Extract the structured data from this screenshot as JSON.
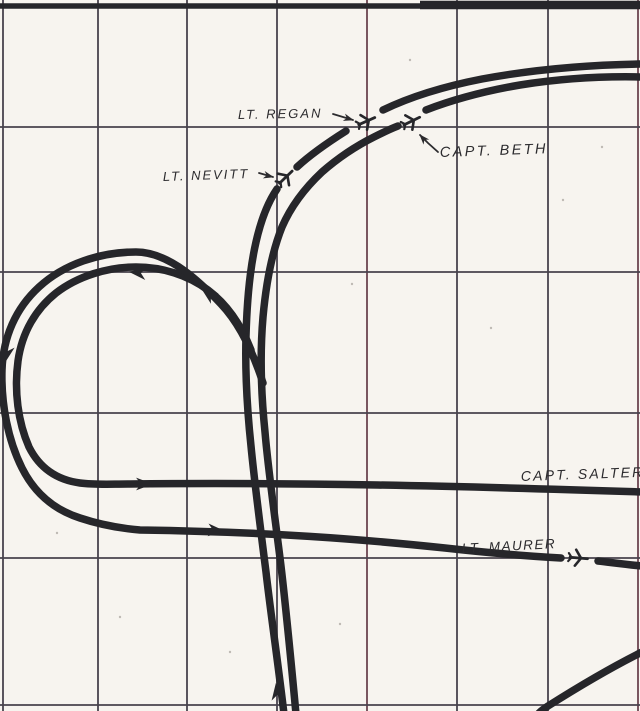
{
  "canvas": {
    "width": 640,
    "height": 711,
    "paper_color": "#f7f4ef",
    "ink_color": "#26262a",
    "label_color": "#2c2b2e",
    "track_width": 7.5
  },
  "grid": {
    "color": "#48434d",
    "accent_color": "#6b4550",
    "line_width": 1.8,
    "vertical_x": [
      3,
      98,
      187,
      277,
      367,
      457,
      548,
      638
    ],
    "accent_vertical_x": [
      367,
      638
    ],
    "horizontal_y": [
      127,
      272,
      413,
      558,
      705
    ],
    "border_segments": [
      {
        "x1": 0,
        "x2": 642,
        "y": 6,
        "width": 5.5
      },
      {
        "x1": 420,
        "x2": 642,
        "y": 5,
        "width": 8.5
      }
    ]
  },
  "specks": [
    [
      352,
      284
    ],
    [
      491,
      328
    ],
    [
      563,
      200
    ],
    [
      120,
      617
    ],
    [
      602,
      147
    ],
    [
      230,
      652
    ],
    [
      410,
      60
    ],
    [
      57,
      533
    ],
    [
      340,
      624
    ]
  ],
  "tracks": [
    {
      "name": "approach-track-regan-nevitt",
      "segments": [
        "M 284,714 C 277,655 270,608 266,572 C 260,525 254,478 251,446 C 247,408 245,372 246,336 C 247,300 250,268 256,242 C 261,220 268,202 277,189",
        "M 297,167 C 310,155 327,143 346,131",
        "M 383,110 C 412,96 446,86 482,79 C 520,72 575,65 642,64"
      ]
    },
    {
      "name": "approach-track-beth",
      "segments": [
        "M 296,714 C 290,650 285,598 280,558 C 274,510 268,468 265,432 C 261,393 260,352 263,317 C 266,284 272,252 282,227 C 292,204 306,187 322,172 C 338,158 356,146 374,137 C 382,133 390,129 398,126",
        "M 426,110 C 452,100 485,91 520,85 C 558,79 600,76 642,77"
      ]
    },
    {
      "name": "loop-track-capt-salter",
      "segments": [
        "M 251,350 C 242,327 228,305 208,290 C 188,275 162,267 136,267 C 108,267 78,276 56,293 C 36,309 22,332 18,361 C 14,391 18,422 29,447 C 40,469 58,480 80,483 C 95,485 110,484 130,484 C 290,482 460,486 642,492"
      ]
    },
    {
      "name": "loop-track-lt-maurer",
      "segments": [
        "M 263,383 C 253,352 240,324 221,304 C 202,284 170,252 136,252 C 100,252 64,264 39,287 C 16,308 3,337 2,370 C 1,404 8,440 22,468 C 35,494 55,510 80,518 C 98,524 116,528 140,530 C 270,532 360,539 445,548 C 490,553 525,556 561,558",
        "M 598,561 C 615,563 630,565 642,566"
      ]
    },
    {
      "name": "corner-track-bottom-right",
      "segments": [
        "M 642,652 C 612,667 578,687 548,706 C 545,708 542,710 539,713"
      ]
    }
  ],
  "direction_arrows": [
    {
      "x": 152,
      "y": 484,
      "angle": 0
    },
    {
      "x": 224,
      "y": 531,
      "angle": 4
    },
    {
      "x": 276,
      "y": 684,
      "angle": -97
    },
    {
      "x": 130,
      "y": 272,
      "angle": 186
    },
    {
      "x": 202,
      "y": 289,
      "angle": 217
    },
    {
      "x": 5,
      "y": 362,
      "angle": 102
    }
  ],
  "planes": [
    {
      "pilot": "LT. REGAN",
      "slug": "lt-regan",
      "x": 367,
      "y": 121,
      "rotate": -24
    },
    {
      "pilot": "CAPT. BETH",
      "slug": "capt-beth",
      "x": 412,
      "y": 121,
      "rotate": -26
    },
    {
      "pilot": "LT. NEVITT",
      "slug": "lt-nevitt",
      "x": 286,
      "y": 177,
      "rotate": -44
    },
    {
      "pilot": "LT. MAURER",
      "slug": "lt-maurer",
      "x": 579,
      "y": 558,
      "rotate": 5
    }
  ],
  "labels": [
    {
      "id": "lt-regan",
      "text": "LT. REGAN",
      "x": 238,
      "y": 119,
      "size": 13,
      "spacing": 2,
      "rotate": -1
    },
    {
      "id": "capt-beth",
      "text": "CAPT. BETH",
      "x": 440,
      "y": 157,
      "size": 14.5,
      "spacing": 2.4,
      "rotate": -2
    },
    {
      "id": "lt-nevitt",
      "text": "LT. NEVITT",
      "x": 163,
      "y": 181,
      "size": 13,
      "spacing": 2,
      "rotate": -2
    },
    {
      "id": "capt-salter",
      "text": "CAPT. SALTER",
      "x": 521,
      "y": 481,
      "size": 14,
      "spacing": 2.2,
      "rotate": -2
    },
    {
      "id": "lt-maurer",
      "text": "LT. MAURER",
      "x": 462,
      "y": 553,
      "size": 13.5,
      "spacing": 1.5,
      "rotate": -3
    }
  ],
  "pointers": [
    {
      "name": "regan-pointer-arrow",
      "points": [
        [
          333,
          114
        ],
        [
          353,
          120
        ]
      ],
      "arrow_angle": 17
    },
    {
      "name": "nevitt-pointer-arrow",
      "points": [
        [
          259,
          173
        ],
        [
          273,
          177
        ]
      ],
      "arrow_angle": 14
    },
    {
      "name": "beth-pointer-line",
      "points": [
        [
          438,
          152
        ],
        [
          428,
          143
        ],
        [
          420,
          135
        ]
      ],
      "arrow_angle": -132
    }
  ]
}
